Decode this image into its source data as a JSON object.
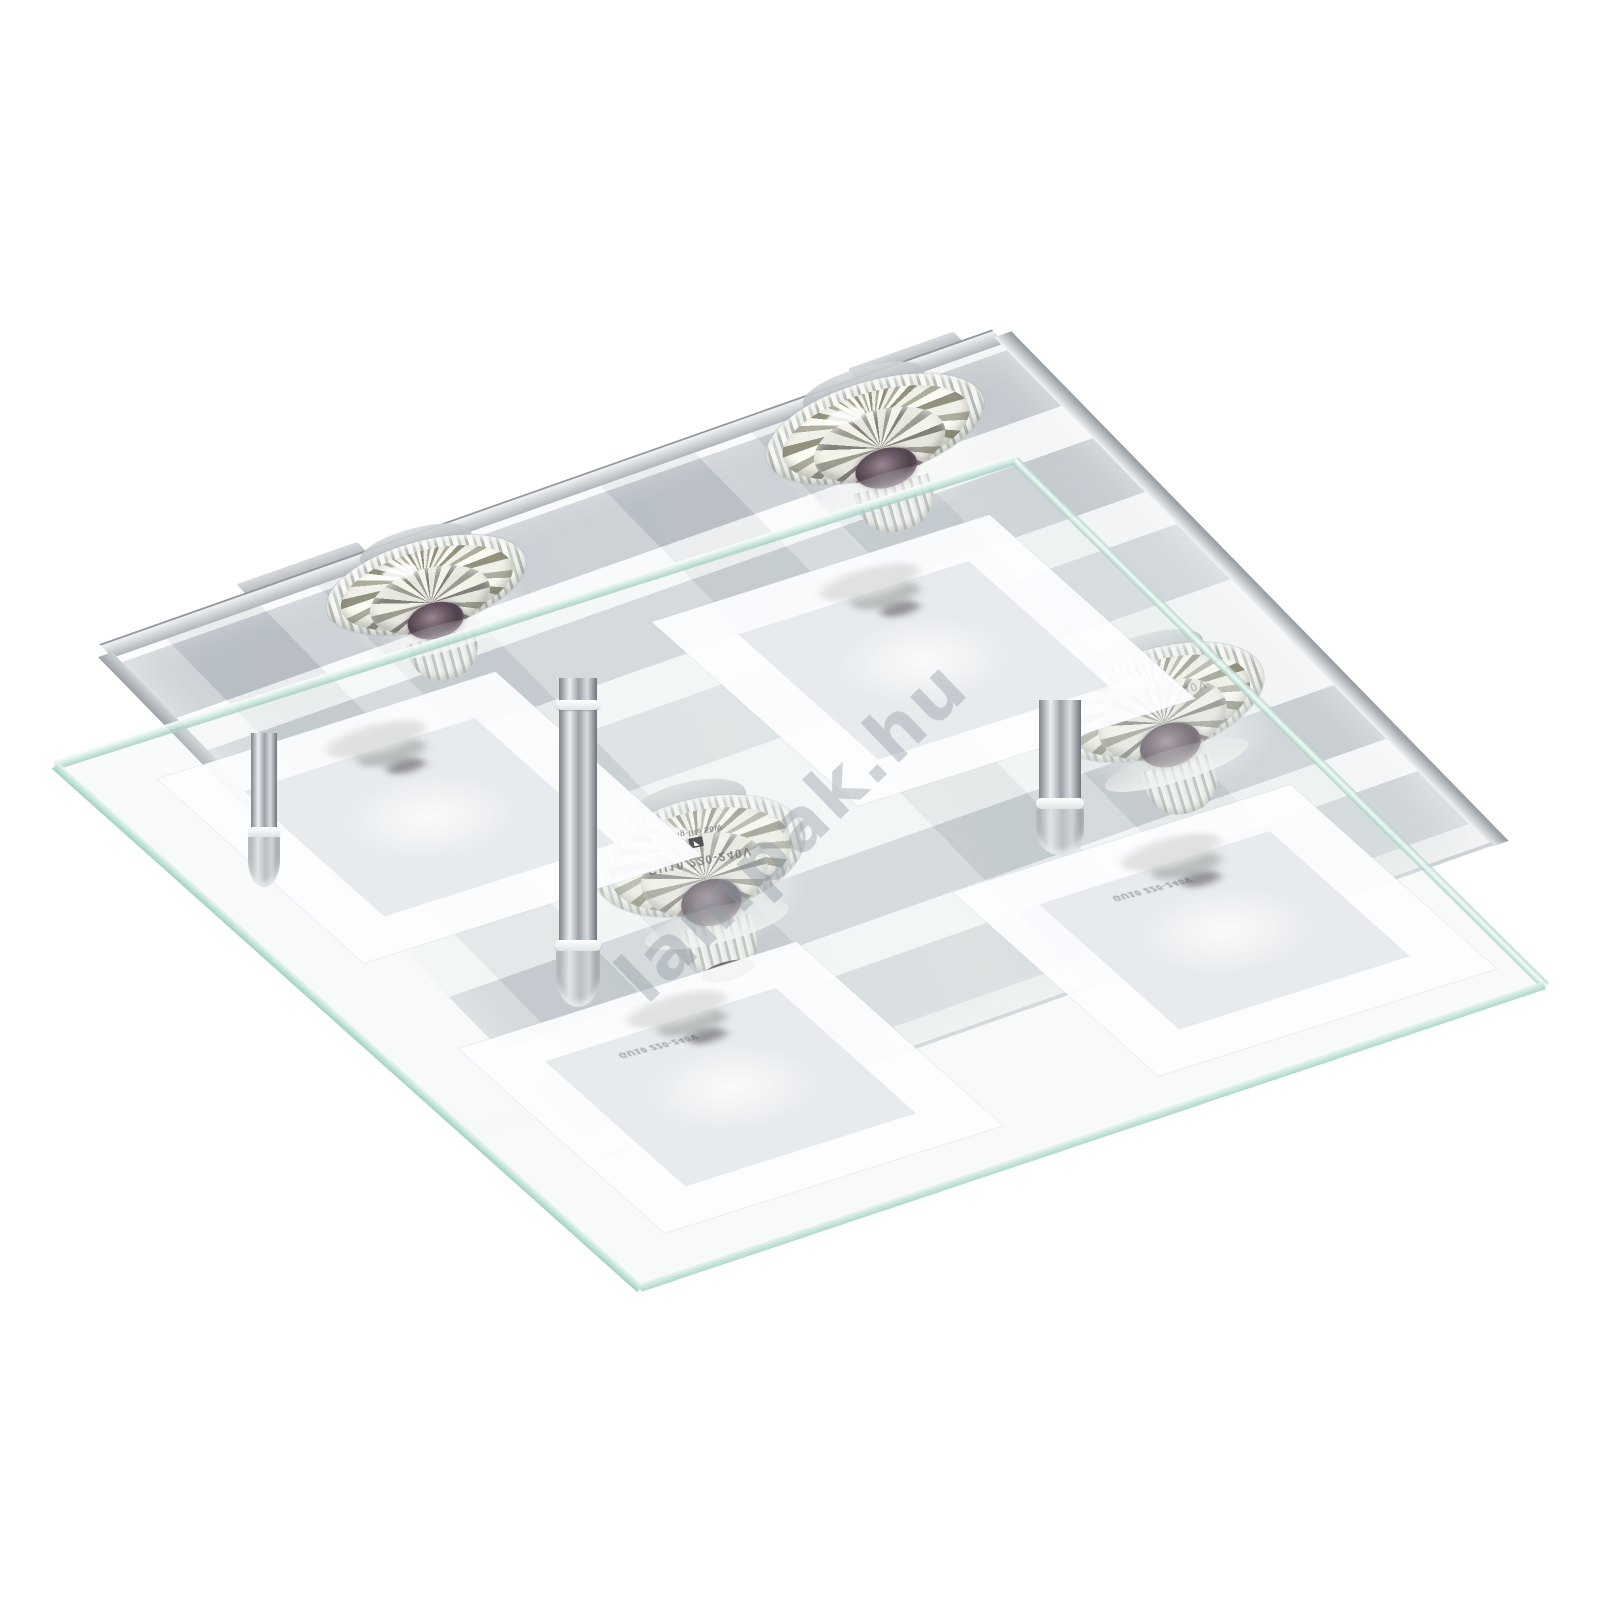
{
  "watermark": {
    "text": "lampak.hu"
  },
  "bulb_marking": {
    "line1": "GU10 220-240V",
    "logo_glyph": "◤",
    "line2": "long-life 50W"
  },
  "bulb_ghost_marking": "GU10 220-240V",
  "palette": {
    "background": "#ffffff",
    "chrome": "#c7ccd1",
    "stripe_gray": "#a8b0b7",
    "frost_white": "#fbfcfd",
    "glass_edge_teal": "#9fd2c2",
    "watermark_gray": "#8b97a0",
    "halogen_core_purple": "#6a5a66"
  }
}
